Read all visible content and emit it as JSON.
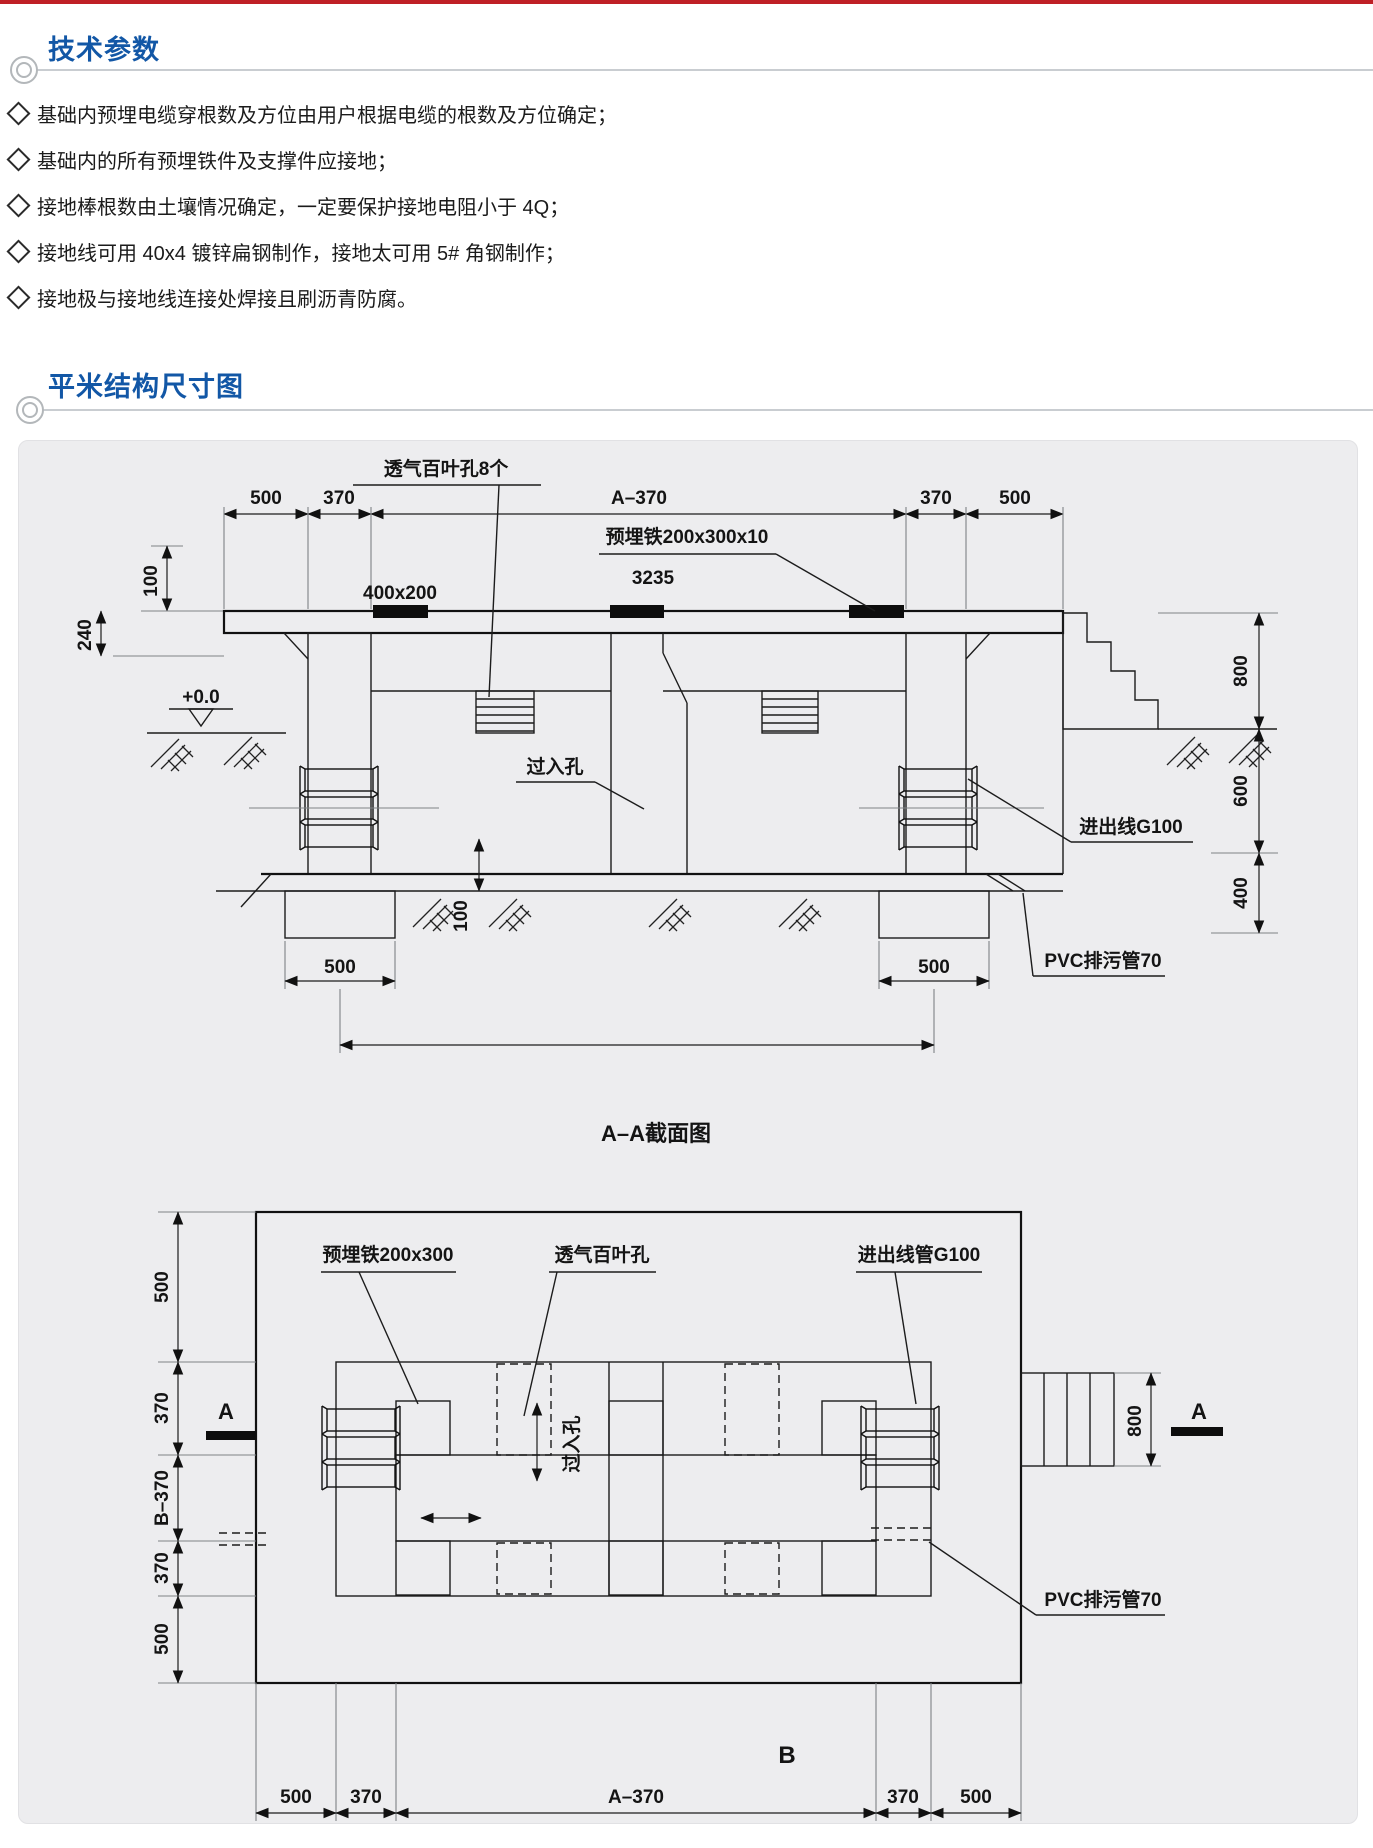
{
  "colors": {
    "top_bar_red": "#bf2026",
    "accent_blue": "#1257a6",
    "panel_bg": "#ededef"
  },
  "header": {
    "section1_title": "技术参数",
    "section2_title": "平米结构尺寸图",
    "bullets": [
      "基础内预埋电缆穿根数及方位由用户根据电缆的根数及方位确定；",
      "基础内的所有预埋铁件及支撑件应接地；",
      "接地棒根数由土壤情况确定，一定要保护接地电阻小于 4Q；",
      "接地线可用 40x4 镀锌扁钢制作，接地太可用 5# 角钢制作；",
      "接地极与接地线连接处焊接且刷沥青防腐。"
    ]
  },
  "section_view": {
    "caption": "A–A截面图",
    "top_dims": [
      "500",
      "370",
      "A–370",
      "370",
      "500"
    ],
    "left_dims": {
      "d100": "100",
      "d240": "240"
    },
    "level": "+0.0",
    "right_dims": [
      "800",
      "600",
      "400"
    ],
    "footing_dims": [
      "500",
      "500"
    ],
    "base_dim": "100",
    "labels": {
      "vent": "透气百叶孔8个",
      "vent_size": "400x200",
      "iron": "预埋铁200x300x10",
      "iron_num": "3235",
      "manhole": "过入孔",
      "cable": "进出线G100",
      "pvc": "PVC排污管70"
    }
  },
  "plan_view": {
    "caption": "B",
    "left_dims": [
      "500",
      "370",
      "B–370",
      "370",
      "500"
    ],
    "bottom_dims": [
      "500",
      "370",
      "A–370",
      "370",
      "500"
    ],
    "right_dim": "800",
    "section_marks": {
      "left": "A",
      "right": "A"
    },
    "labels": {
      "iron": "预埋铁200x300",
      "vent": "透气百叶孔",
      "cable": "进出线管G100",
      "manhole": "过入孔",
      "pvc": "PVC排污管70"
    }
  }
}
